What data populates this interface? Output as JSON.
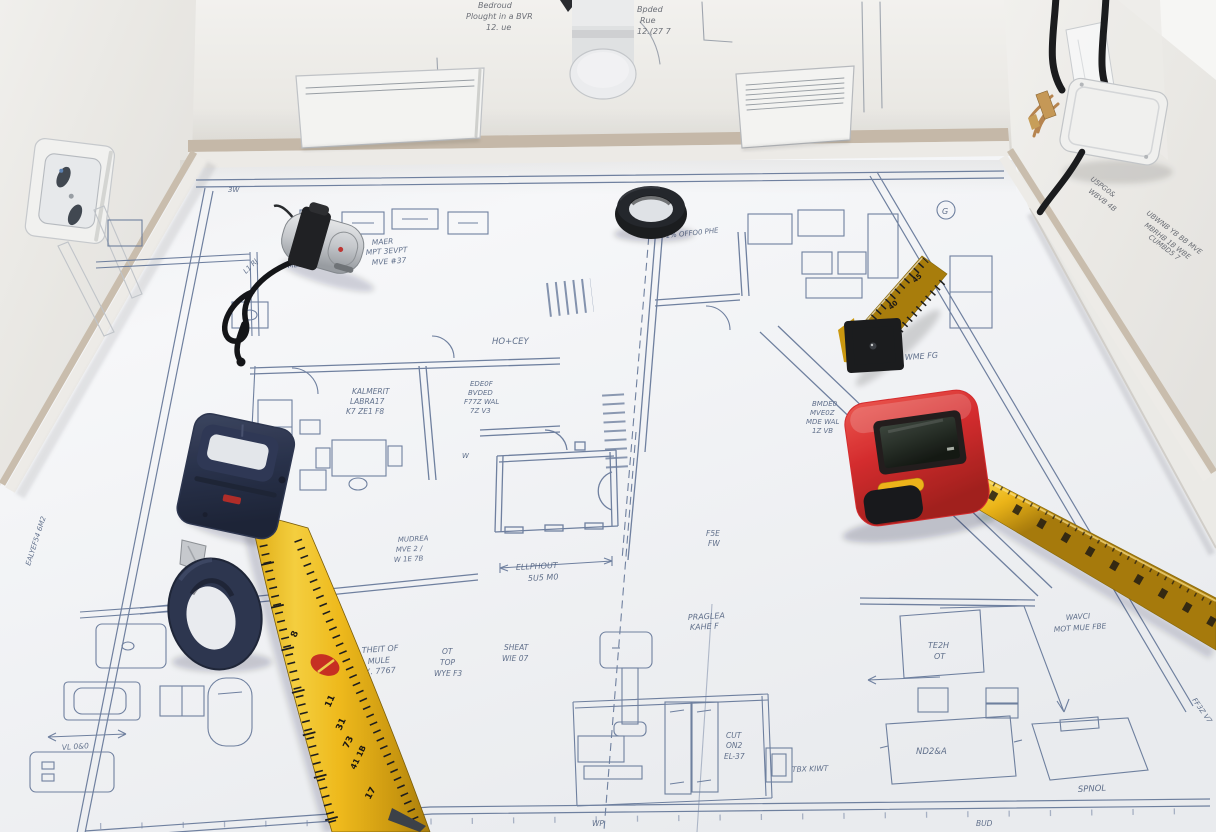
{
  "scene": {
    "title": "Architectural floor-plan blueprint spread over the floor of a white model room, with measuring tools lying on it",
    "objects": {
      "black_ring": "black rubber ring",
      "mini_tape": "silver mini tape measure with black lanyard",
      "navy_tape": "navy tape measure with extended yellow blade",
      "navy_ring": "navy rubber grip ring with metal clip",
      "folding_rule": "yellow folding rule segment with black joint",
      "laser_meter": "red digital measuring device with LCD and yellow tape",
      "outlet": "white wall power outlet",
      "junction_box": "white junction box with black cables and copper wires",
      "heater_left": "white wall panel heater",
      "heater_right": "white wall panel heater with vent grille",
      "valve": "white radiator valve knob"
    }
  },
  "colors": {
    "plan_ink": "#64779a",
    "paper": "#fafbfd",
    "device_red": "#d8292b",
    "navy": "#2a334e",
    "ring_black": "#17191c",
    "accent_yellow": "#f2b616",
    "tape_yellow": "#f3bc18"
  },
  "wall_notes": {
    "left": [
      "Bedroud",
      "Plought in a BVR",
      "12. ue"
    ],
    "right": [
      "Bpded",
      "Rue",
      "12.(27 7"
    ],
    "scribble_a": [
      "U5PG0&",
      "WBVB 4B"
    ],
    "scribble_b": [
      "UBWNB YB BB MVE",
      "MBRHB 1B WBE",
      "CUMBD5 7"
    ]
  },
  "plan": {
    "ann": {
      "tick_tl": "3W",
      "offset": "1% OFFO0 PHE",
      "maer": [
        "MAER",
        "MPT 3EVPT",
        "MVE #37"
      ],
      "meet": "MEET FETY",
      "lr": "L1 RJ",
      "hocey": "HO+CEY",
      "kalmerit": [
        "KALMERIT",
        "LABRA17",
        "K7 ZE1 F8"
      ],
      "edeof": [
        "EDE0F",
        "BVDED",
        "F77Z WAL",
        "7Z V3"
      ],
      "bmdeo": [
        "BMDE0",
        "MVE0Z",
        "MDE WAL",
        "1Z VB"
      ],
      "wme": "WME  FG",
      "fse": [
        "F5E",
        "FW"
      ],
      "ellphout": [
        "ELLPHOUT",
        "5U5 M0"
      ],
      "mudrea": [
        "MUDREA",
        "MVE 2 /",
        "W 1E 7B"
      ],
      "theit": [
        "THEIT OF",
        "MULE",
        "EX. 7767"
      ],
      "ot": [
        "OT",
        "TOP",
        "WYE F3"
      ],
      "sheat": [
        "SHEAT",
        "WIE 07"
      ],
      "praglea": [
        "PRAGLEA",
        "KAHE F"
      ],
      "cut": [
        "CUT",
        "ON2",
        "EL-37"
      ],
      "tbx": "TBX KIWT",
      "tezh": [
        "TE2H",
        "OT"
      ],
      "ndza": "ND2&A",
      "spnol": "SPNOL",
      "wavci": [
        "WAVCI",
        "MOT MUE FBE"
      ],
      "vloo": "VL 0&0",
      "wp": "WP",
      "bud": "BUD",
      "g": "G",
      "w": "W",
      "side_rot": "FF3Z V7",
      "left_rot": "EALYEF54 6M2"
    }
  },
  "tools": {
    "navy_tape_numbers": [
      "8",
      "11",
      "31",
      "73",
      "41 1B",
      "17"
    ],
    "rule_numbers": [
      "40",
      "45"
    ]
  }
}
